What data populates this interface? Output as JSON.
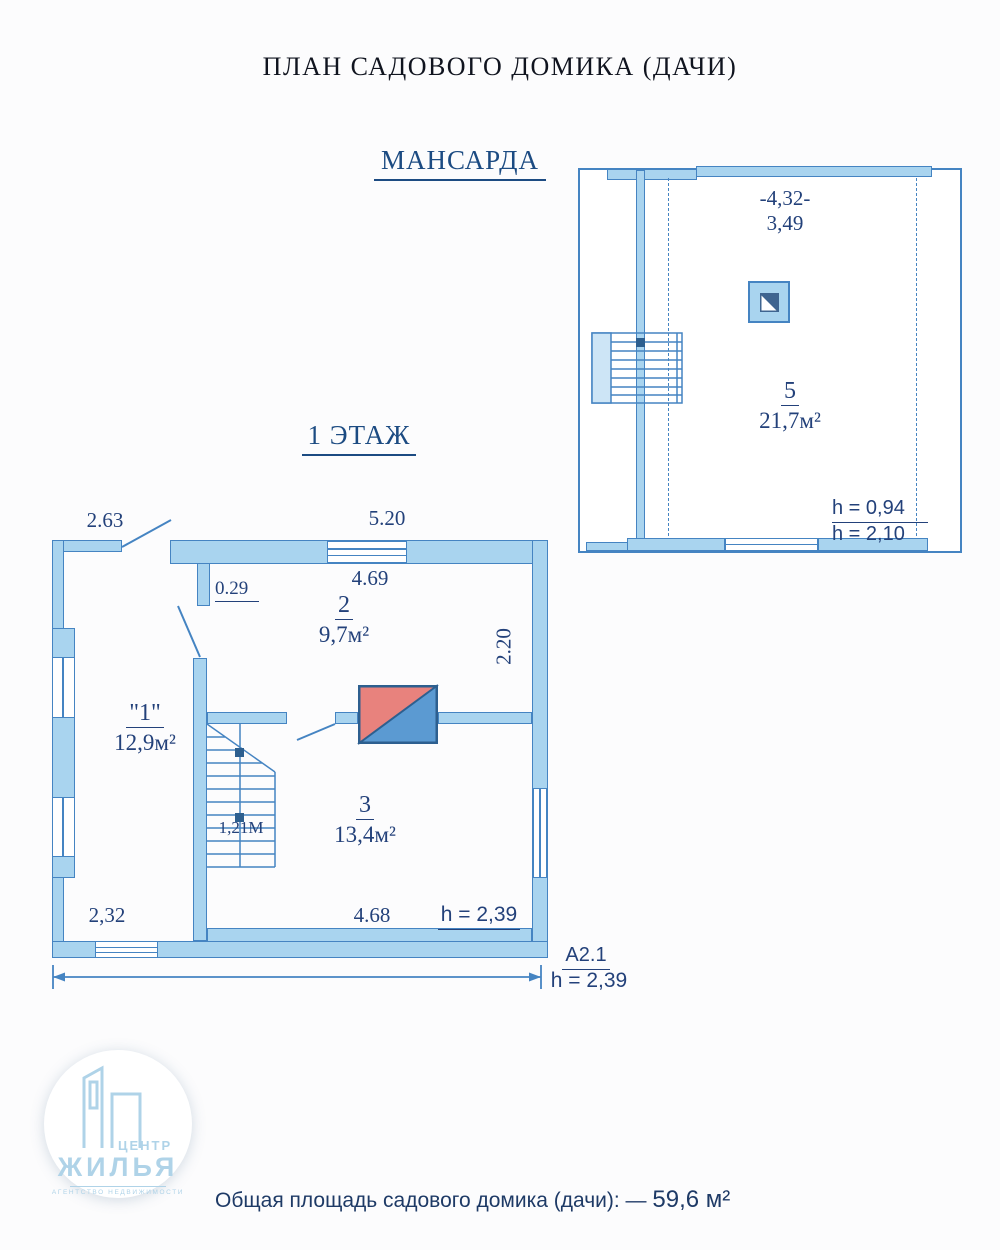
{
  "title": "ПЛАН САДОВОГО ДОМИКА (ДАЧИ)",
  "colors": {
    "wall-fill": "#a9d4ef",
    "wall-stroke": "#4584c2",
    "light-fill": "#cde5f6",
    "navy": "#23417a",
    "heading": "#1c4b82",
    "stove-red": "#e8827d",
    "stove-blue": "#5b9ad2",
    "chimney": "#3e6490",
    "logo-blue": "#afd3e8",
    "footer-navy": "#1e3a66"
  },
  "mansarda": {
    "label": "МАНСАРДА",
    "overall_width": "-4,32-",
    "inner_width": "3,49",
    "room": {
      "number": "5",
      "area": "21,7м²"
    },
    "height_low": "h = 0,94",
    "height_high": "h = 2,10"
  },
  "floor1": {
    "label": "1 ЭТАЖ",
    "rooms": {
      "veranda": {
        "number": "\"1\"",
        "area": "12,9м²"
      },
      "room2": {
        "number": "2",
        "area": "9,7м²"
      },
      "room3": {
        "number": "3",
        "area": "13,4м²"
      }
    },
    "dims": {
      "veranda_top": "2.63",
      "facade_top": "5.20",
      "room2_width": "4.69",
      "pier": "0.29",
      "room2_depth": "2.20",
      "veranda_bottom": "2,32",
      "room3_width": "4.68",
      "stair_width": "1,21М",
      "ceiling": "h = 2,39"
    },
    "section": {
      "label": "А2.1",
      "height": "h = 2,39"
    }
  },
  "logo": {
    "top": "ЦЕНТР",
    "main": "ЖИЛЬЯ",
    "sub": "АГЕНТСТВО НЕДВИЖИМОСТИ"
  },
  "footer": {
    "label": "Общая площадь садового домика (дачи): —",
    "value": "59,6 м²"
  }
}
